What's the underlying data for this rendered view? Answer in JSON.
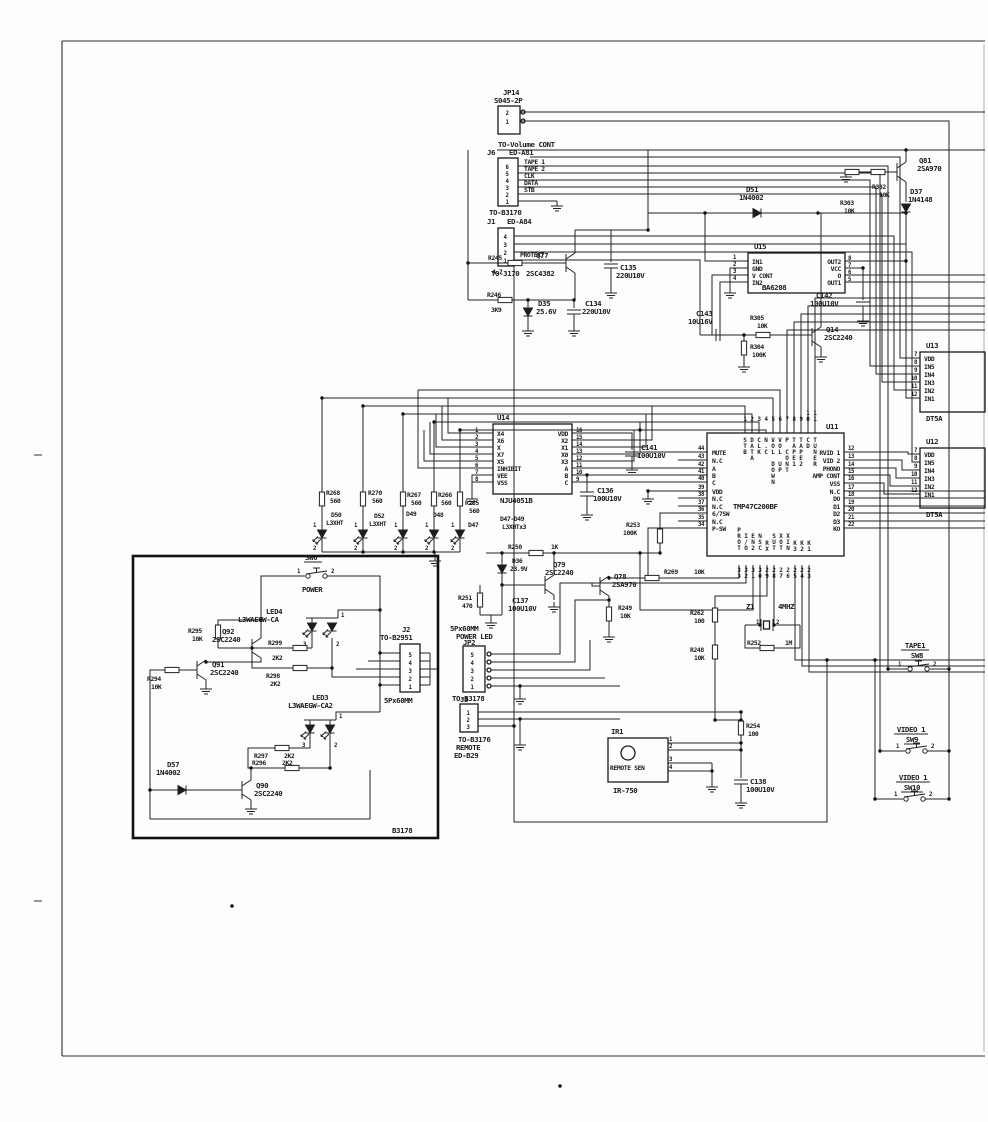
{
  "board": {
    "inset_ref": "B3178"
  },
  "connectors": {
    "jp14": {
      "ref": "JP14",
      "part": "S045-2P",
      "note": "TO-Volume CONT",
      "pins": [
        "2",
        "1"
      ]
    },
    "j6": {
      "ref": "J6",
      "part": "ED-A81",
      "note": "TO-B3170",
      "pins": [
        "6",
        "5",
        "4",
        "3",
        "2",
        "1"
      ],
      "signals": [
        "TAPE 1",
        "TAPE 2",
        "CLK",
        "DATA",
        "STB"
      ]
    },
    "j1": {
      "ref": "J1",
      "part": "ED-A84",
      "note": "TO-3170",
      "signal": "PROTECT",
      "pins": [
        "4",
        "3",
        "2",
        "1"
      ]
    },
    "j2": {
      "ref": "J2",
      "note": "TO-B2951",
      "size": "5Px60MM",
      "pins": [
        "5",
        "4",
        "3",
        "2",
        "1"
      ]
    },
    "jp2": {
      "ref": "JP2",
      "size": "5Px60MM",
      "function": "POWER LED",
      "note": "TO-B3178",
      "pins": [
        "5",
        "4",
        "3",
        "2",
        "1"
      ]
    },
    "j3": {
      "ref": "J3",
      "note": "TO-B3176",
      "function": "REMOTE",
      "dest": "ED-B29",
      "pins": [
        "1",
        "2",
        "3"
      ]
    }
  },
  "ics": {
    "u15": {
      "ref": "U15",
      "part": "BA6208",
      "left": [
        {
          "n": "1",
          "l": "IN1"
        },
        {
          "n": "2",
          "l": "GND"
        },
        {
          "n": "3",
          "l": "V CONT"
        },
        {
          "n": "4",
          "l": "IN2"
        }
      ],
      "right": [
        {
          "n": "8",
          "l": "OUT2"
        },
        {
          "n": "7",
          "l": "VCC"
        },
        {
          "n": "6",
          "l": "O"
        },
        {
          "n": "5",
          "l": "OUT1"
        }
      ]
    },
    "u14": {
      "ref": "U14",
      "part": "NJU4051B",
      "left": [
        {
          "n": "1",
          "l": "X4"
        },
        {
          "n": "2",
          "l": "X6"
        },
        {
          "n": "3",
          "l": "X"
        },
        {
          "n": "4",
          "l": "X7"
        },
        {
          "n": "5",
          "l": "X5"
        },
        {
          "n": "6",
          "l": "INHIBIT"
        },
        {
          "n": "7",
          "l": "VEE"
        },
        {
          "n": "8",
          "l": "VSS"
        }
      ],
      "right": [
        {
          "n": "16",
          "l": "VDD"
        },
        {
          "n": "15",
          "l": "X2"
        },
        {
          "n": "14",
          "l": "X1"
        },
        {
          "n": "13",
          "l": "X0"
        },
        {
          "n": "12",
          "l": "X3"
        },
        {
          "n": "11",
          "l": "A"
        },
        {
          "n": "10",
          "l": "B"
        },
        {
          "n": "9",
          "l": "C"
        }
      ]
    },
    "u13": {
      "ref": "U13",
      "part": "DT5A",
      "pins": [
        {
          "n": "7",
          "l": "VDD"
        },
        {
          "n": "8",
          "l": "IN5"
        },
        {
          "n": "9",
          "l": "IN4"
        },
        {
          "n": "10",
          "l": "IN3"
        },
        {
          "n": "11",
          "l": "IN2"
        },
        {
          "n": "12",
          "l": "IN1"
        }
      ]
    },
    "u12": {
      "ref": "U12",
      "part": "DT5A",
      "pins": [
        {
          "n": "7",
          "l": "VDD"
        },
        {
          "n": "8",
          "l": "IN5"
        },
        {
          "n": "9",
          "l": "IN4"
        },
        {
          "n": "10",
          "l": "IN3"
        },
        {
          "n": "11",
          "l": "IN2"
        },
        {
          "n": "12",
          "l": "IN1"
        }
      ]
    },
    "u11": {
      "ref": "U11",
      "part": "TMP47C200BF",
      "top": [
        {
          "n": "1",
          "l": "STB"
        },
        {
          "n": "2",
          "l": "DATA"
        },
        {
          "n": "3",
          "l": "CLK"
        },
        {
          "n": "4",
          "l": "N.C"
        },
        {
          "n": "5",
          "l": "VOL DOWN"
        },
        {
          "n": "6",
          "l": "VOL UP"
        },
        {
          "n": "7",
          "l": "P CONT"
        },
        {
          "n": "8",
          "l": "TAPE1"
        },
        {
          "n": "9",
          "l": "TAPE2"
        },
        {
          "n": "10",
          "l": "CD"
        },
        {
          "n": "11",
          "l": "TUNER"
        }
      ],
      "left": [
        {
          "n": "44",
          "l": "MUTE"
        },
        {
          "n": "43",
          "l": "N.C"
        },
        {
          "n": "42",
          "l": "A"
        },
        {
          "n": "41",
          "l": "B"
        },
        {
          "n": "40",
          "l": "C"
        },
        {
          "n": "39",
          "l": "VDD"
        },
        {
          "n": "38",
          "l": "N.C"
        },
        {
          "n": "37",
          "l": "N.C"
        },
        {
          "n": "36",
          "l": "6/7SW"
        },
        {
          "n": "35",
          "l": "N.C"
        },
        {
          "n": "34",
          "l": "P-SW"
        }
      ],
      "right": [
        {
          "n": "12",
          "l": "RVID 1"
        },
        {
          "n": "13",
          "l": "VID 2"
        },
        {
          "n": "14",
          "l": "PHONO"
        },
        {
          "n": "15",
          "l": "AMP CONT"
        },
        {
          "n": "16",
          "l": "VSS"
        },
        {
          "n": "17",
          "l": "N.C"
        },
        {
          "n": "18",
          "l": "DO"
        },
        {
          "n": "19",
          "l": "D1"
        },
        {
          "n": "20",
          "l": "D2"
        },
        {
          "n": "21",
          "l": "D3"
        },
        {
          "n": "22",
          "l": "KO"
        }
      ],
      "bottom": [
        {
          "n": "33",
          "l": "PROT"
        },
        {
          "n": "32",
          "l": "I/O"
        },
        {
          "n": "31",
          "l": "EN2"
        },
        {
          "n": "30",
          "l": "NSC"
        },
        {
          "n": "29",
          "l": "RX"
        },
        {
          "n": "28",
          "l": "SUT"
        },
        {
          "n": "27",
          "l": "XOT"
        },
        {
          "n": "26",
          "l": "XIN"
        },
        {
          "n": "25",
          "l": "K3"
        },
        {
          "n": "24",
          "l": "K2"
        },
        {
          "n": "23",
          "l": "K1"
        }
      ]
    }
  },
  "transistors": {
    "q14": {
      "ref": "Q14",
      "part": "2SC2240"
    },
    "q77": {
      "ref": "Q77",
      "part": "2SC4382"
    },
    "q78": {
      "ref": "Q78",
      "part": "2SA970"
    },
    "q79": {
      "ref": "Q79",
      "part": "2SC2240"
    },
    "q81": {
      "ref": "Q81",
      "part": "2SA970"
    },
    "q90": {
      "ref": "Q90",
      "part": "2SC2240"
    },
    "q91": {
      "ref": "Q91",
      "part": "2SC2240"
    },
    "q92": {
      "ref": "Q92",
      "part": "2SC2240"
    }
  },
  "diodes": {
    "d35": {
      "ref": "D35",
      "value": "25.6V"
    },
    "d36": {
      "ref": "D36",
      "value": "23.9V"
    },
    "d37": {
      "ref": "D37",
      "part": "1N4148"
    },
    "d51": {
      "ref": "D51",
      "part": "1N4002"
    },
    "d57": {
      "ref": "D57",
      "part": "1N4002"
    }
  },
  "leds": {
    "d50": {
      "ref": "D50",
      "part": "L3XHT"
    },
    "d52": {
      "ref": "D52",
      "part": "L3XHT"
    },
    "d49": {
      "ref": "D49"
    },
    "d48": {
      "ref": "D48"
    },
    "d47": {
      "ref": "D47"
    },
    "group": {
      "refs": "D47-D49",
      "part": "L3XHTx3"
    },
    "led4": {
      "ref": "LED4",
      "part": "L3WAEGW-CA",
      "pins": [
        "1",
        "3",
        "2"
      ]
    },
    "led3": {
      "ref": "LED3",
      "part": "L3WAEGW-CA2",
      "pins": [
        "1",
        "3",
        "2"
      ]
    },
    "pin_top": "1",
    "pin_bottom": "2"
  },
  "resistors": {
    "r245": {
      "ref": "R245",
      "value": "4.7"
    },
    "r246": {
      "ref": "R246",
      "value": "3K9"
    },
    "r248": {
      "ref": "R248",
      "value": "10K"
    },
    "r249": {
      "ref": "R249",
      "value": "10K"
    },
    "r250": {
      "ref": "R250",
      "value": "1K"
    },
    "r251": {
      "ref": "R251",
      "value": "470"
    },
    "r252": {
      "ref": "R252",
      "value": "1M"
    },
    "r253": {
      "ref": "R253",
      "value": "100K"
    },
    "r254": {
      "ref": "R254",
      "value": "100"
    },
    "r262": {
      "ref": "R262",
      "value": "100"
    },
    "r265": {
      "ref": "R265",
      "value": "560"
    },
    "r266": {
      "ref": "R266",
      "value": "560"
    },
    "r267": {
      "ref": "R267",
      "value": "560"
    },
    "r268": {
      "ref": "R268",
      "value": "560"
    },
    "r269": {
      "ref": "R269",
      "value": "10K"
    },
    "r270": {
      "ref": "R270",
      "value": "560"
    },
    "r294": {
      "ref": "R294",
      "value": "10K"
    },
    "r295": {
      "ref": "R295",
      "value": "10K"
    },
    "r296": {
      "ref": "R296",
      "value": "2K2"
    },
    "r297": {
      "ref": "R297",
      "value": "2K2"
    },
    "r298": {
      "ref": "R298",
      "value": "2K2"
    },
    "r299": {
      "ref": "R299",
      "value": "2K2"
    },
    "r302": {
      "ref": "R302",
      "value": "10K"
    },
    "r303": {
      "ref": "R303",
      "value": "10K"
    },
    "r304": {
      "ref": "R304",
      "value": "100K"
    },
    "r305": {
      "ref": "R305",
      "value": "10K"
    }
  },
  "capacitors": {
    "c134": {
      "ref": "C134",
      "value": "220U10V"
    },
    "c135": {
      "ref": "C135",
      "value": "220U10V"
    },
    "c136": {
      "ref": "C136",
      "value": "100U10V"
    },
    "c137": {
      "ref": "C137",
      "value": "100U10V"
    },
    "c138": {
      "ref": "C138",
      "value": "100U10V"
    },
    "c141": {
      "ref": "C141",
      "value": "100U10V"
    },
    "c142": {
      "ref": "C142",
      "value": "100U10V"
    },
    "c143": {
      "ref": "C143",
      "value": "10U16V"
    }
  },
  "switches": {
    "sw6": {
      "ref": "SW6",
      "label": "POWER",
      "pins": [
        "1",
        "2"
      ]
    },
    "sw8": {
      "ref": "SW8",
      "label": "TAPE1",
      "pins": [
        "1",
        "2"
      ]
    },
    "sw9": {
      "ref": "SW9",
      "label": "VIDEO 1",
      "pins": [
        "1",
        "2"
      ]
    },
    "sw10": {
      "ref": "SW10",
      "label": "VIDEO 1",
      "pins": [
        "1",
        "2"
      ]
    }
  },
  "crystal": {
    "ref": "Z1",
    "value": "4MHZ",
    "pins": [
      "1",
      "2"
    ]
  },
  "ir_receiver": {
    "ref": "IR1",
    "label": "REMOTE SEN",
    "part": "IR-750",
    "pins": [
      "1",
      "2",
      "3",
      "4"
    ]
  }
}
